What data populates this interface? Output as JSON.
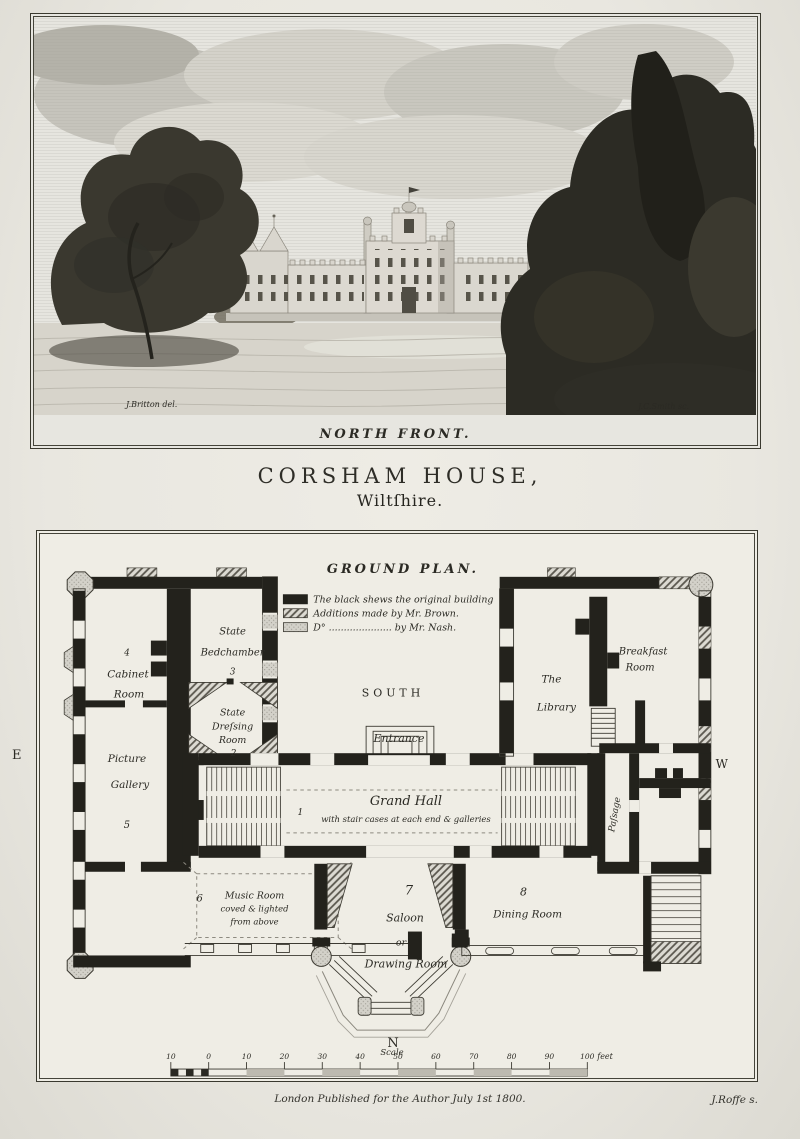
{
  "engraving": {
    "caption": "NORTH FRONT.",
    "credit_left": "J.Britton del.",
    "credit_right": "J.C.Smith sc."
  },
  "title": {
    "main": "CORSHAM HOUSE,",
    "sub": "Wiltſhire."
  },
  "plan": {
    "heading": "GROUND PLAN.",
    "legend": {
      "items": [
        {
          "style": "black",
          "label": "The black shews the original building"
        },
        {
          "style": "hatch",
          "label": "Additions made by Mr. Brown."
        },
        {
          "style": "stipple",
          "label": "D° ..................... by Mr. Nash."
        }
      ]
    },
    "compass": {
      "south": "SOUTH",
      "east": "E",
      "west": "W",
      "north": "N"
    },
    "labels": {
      "cabinet_num": "4",
      "cabinet_1": "Cabinet",
      "cabinet_2": "Room",
      "bed_1": "State",
      "bed_2": "Bedchamber",
      "bed_num": "3",
      "dress_1": "State",
      "dress_2": "Dreſsing",
      "dress_3": "Room",
      "dress_num": "2",
      "gallery_1": "Picture",
      "gallery_2": "Gallery",
      "gallery_num": "5",
      "entrance": "Entrance",
      "hall_num": "1",
      "hall_name": "Grand Hall",
      "hall_note": "with stair cases at each end & galleries",
      "library_1": "The",
      "library_2": "Library",
      "breakfast_1": "Breakfast",
      "breakfast_2": "Room",
      "passage": "Paſsage",
      "music_num": "6",
      "music_1": "Music Room",
      "music_2": "coved & lighted",
      "music_3": "from above",
      "saloon_num": "7",
      "saloon_1": "Saloon",
      "saloon_2": "or",
      "saloon_3": "Drawing Room",
      "dining_num": "8",
      "dining": "Dining Room"
    },
    "scale": {
      "label": "Scale",
      "ticks": [
        "10",
        "0",
        "10",
        "20",
        "30",
        "40",
        "50",
        "60",
        "70",
        "80",
        "90",
        "100"
      ],
      "unit": "feet"
    }
  },
  "footer": {
    "publication": "London Published for the Author July 1st 1800.",
    "engraver": "J.Roffe s."
  }
}
